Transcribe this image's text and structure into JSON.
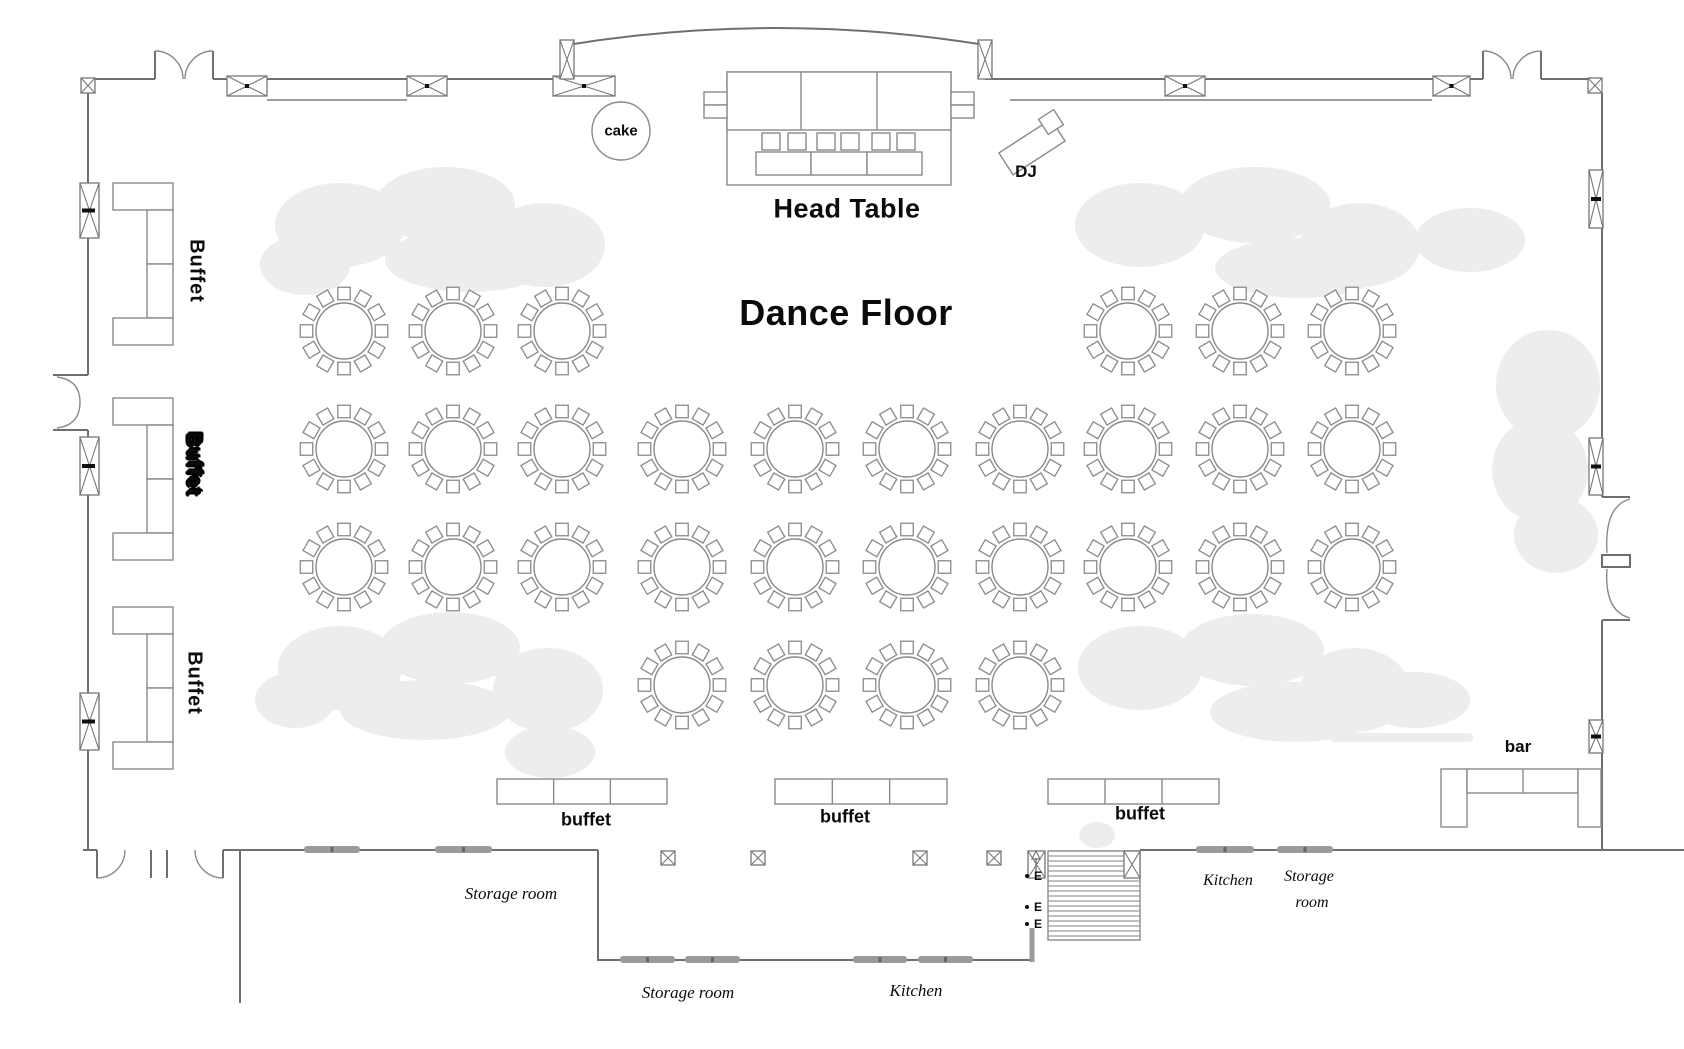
{
  "labels": {
    "head_table": "Head Table",
    "dance_floor": "Dance Floor",
    "cake": "cake",
    "dj": "DJ",
    "bar": "bar",
    "buffet_bottom": [
      "buffet",
      "buffet",
      "buffet"
    ],
    "buffet_left": [
      "Buffet",
      "Buffet",
      "Buffet"
    ],
    "storage_room_left": "Storage room",
    "storage_room_bottom": "Storage room",
    "kitchen_bottom": "Kitchen",
    "kitchen_right": "Kitchen",
    "storage_right_l1": "Storage",
    "storage_right_l2": "room",
    "exit": [
      "E",
      "E",
      "E"
    ]
  },
  "colors": {
    "wall": "#6f6f6f",
    "furniture_line": "#8a8a8a",
    "door_marker": "#9b9b9b",
    "foliage": "#ededed",
    "text": "#0b0b0b"
  },
  "floorplan": {
    "round_table": {
      "radius": 28,
      "chair_ring": 37.5,
      "chair_size": 12.5,
      "chairs": 12
    },
    "round_tables": [
      {
        "x": 344,
        "y": 331
      },
      {
        "x": 453,
        "y": 331
      },
      {
        "x": 562,
        "y": 331
      },
      {
        "x": 1128,
        "y": 331
      },
      {
        "x": 1240,
        "y": 331
      },
      {
        "x": 1352,
        "y": 331
      },
      {
        "x": 344,
        "y": 449
      },
      {
        "x": 453,
        "y": 449
      },
      {
        "x": 562,
        "y": 449
      },
      {
        "x": 682,
        "y": 449
      },
      {
        "x": 795,
        "y": 449
      },
      {
        "x": 907,
        "y": 449
      },
      {
        "x": 1020,
        "y": 449
      },
      {
        "x": 1128,
        "y": 449
      },
      {
        "x": 1240,
        "y": 449
      },
      {
        "x": 1352,
        "y": 449
      },
      {
        "x": 344,
        "y": 567
      },
      {
        "x": 453,
        "y": 567
      },
      {
        "x": 562,
        "y": 567
      },
      {
        "x": 682,
        "y": 567
      },
      {
        "x": 795,
        "y": 567
      },
      {
        "x": 907,
        "y": 567
      },
      {
        "x": 1020,
        "y": 567
      },
      {
        "x": 1128,
        "y": 567
      },
      {
        "x": 1240,
        "y": 567
      },
      {
        "x": 1352,
        "y": 567
      },
      {
        "x": 682,
        "y": 685
      },
      {
        "x": 795,
        "y": 685
      },
      {
        "x": 907,
        "y": 685
      },
      {
        "x": 1020,
        "y": 685
      }
    ],
    "windows_top": [
      [
        227,
        267
      ],
      [
        407,
        447
      ],
      [
        553,
        615
      ],
      [
        1165,
        1205
      ],
      [
        1433,
        1470
      ]
    ],
    "stage_strips": [
      [
        560,
        40
      ],
      [
        978,
        40
      ]
    ],
    "windows_left": [
      [
        183,
        238
      ],
      [
        437,
        495
      ],
      [
        693,
        750
      ]
    ],
    "windows_right": [
      [
        170,
        228
      ],
      [
        438,
        495
      ],
      [
        720,
        753
      ]
    ],
    "corner_markers": [
      [
        81,
        78
      ],
      [
        1588,
        78
      ]
    ],
    "column_markers": [
      668,
      758,
      920,
      994
    ],
    "door_markers_main": [
      [
        304,
        360
      ],
      [
        435,
        492
      ],
      [
        1196,
        1254
      ],
      [
        1277,
        1333
      ]
    ],
    "door_markers_ext": [
      [
        620,
        675
      ],
      [
        685,
        740
      ],
      [
        853,
        907
      ],
      [
        918,
        973
      ]
    ],
    "left_buffets_y": [
      183,
      398,
      607
    ],
    "bottom_buffets": [
      {
        "x": 497,
        "w": 170
      },
      {
        "x": 775,
        "w": 172
      },
      {
        "x": 1048,
        "w": 171
      }
    ],
    "stairs": {
      "x1": 1048,
      "y1": 851,
      "x2": 1140,
      "y2": 940
    }
  }
}
